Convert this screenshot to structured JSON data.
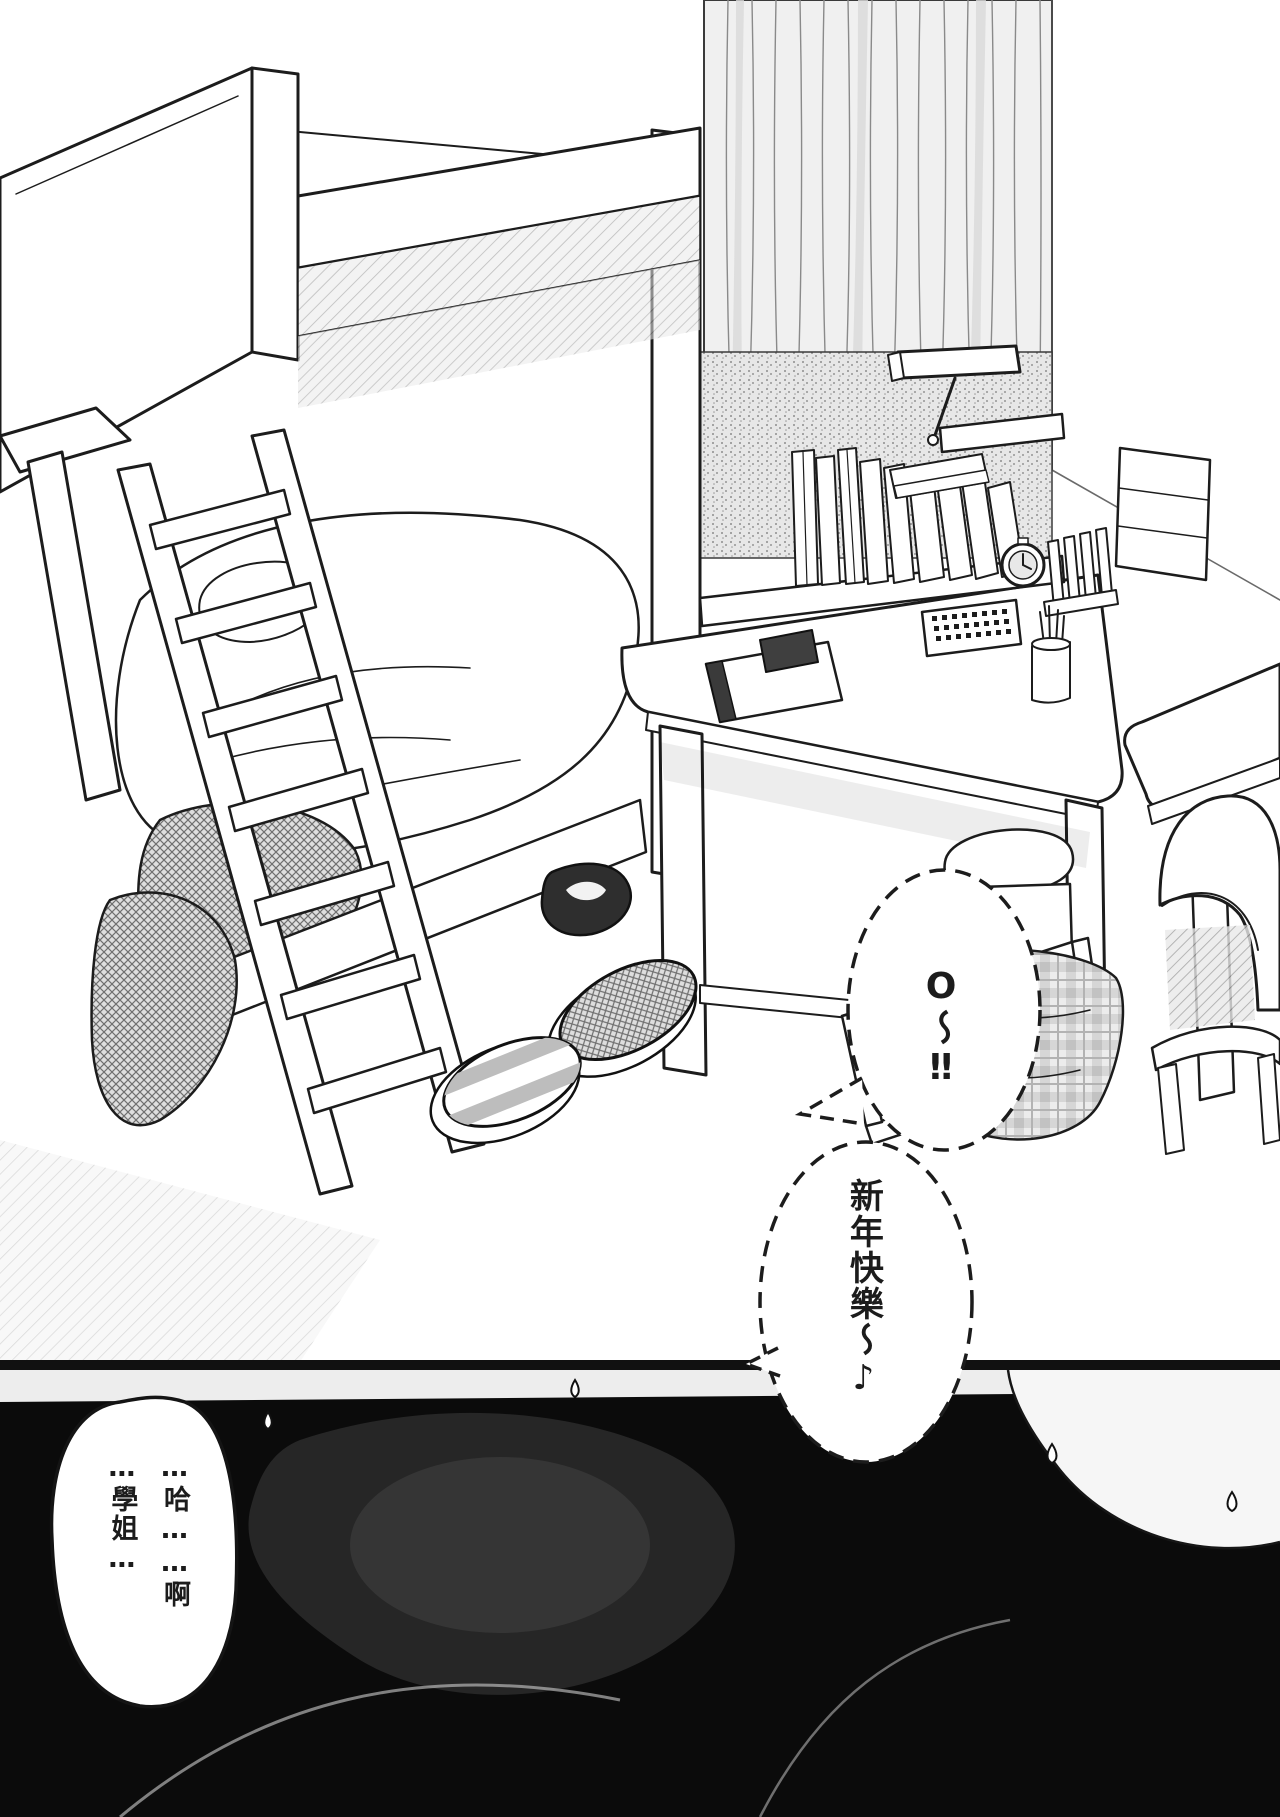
{
  "colors": {
    "paper": "#ffffff",
    "ink": "#1c1c1c",
    "panel2_bg": "#0b0b0b",
    "tone_gray": "#d8d8d8"
  },
  "dialogue": {
    "exclaim": "O〜‼",
    "greeting": "新年快樂〜♪",
    "gasp": "…哈……啊\n…學姐…"
  }
}
